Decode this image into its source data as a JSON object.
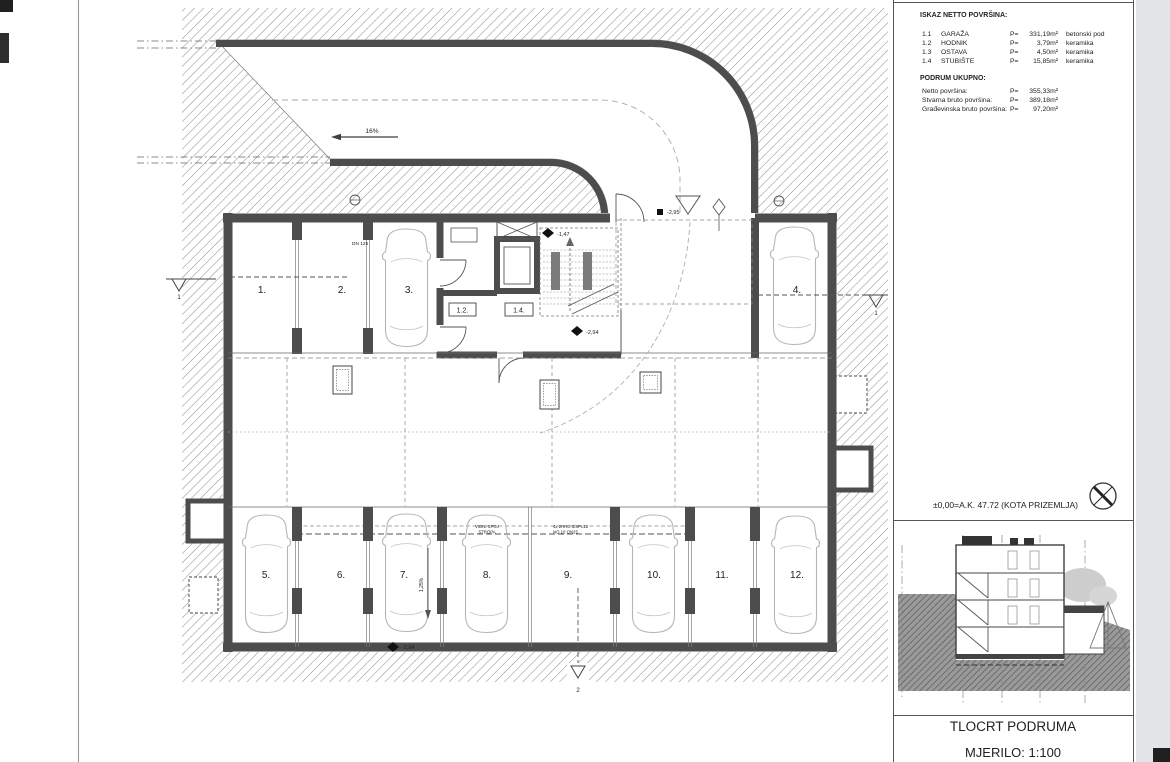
{
  "panel": {
    "header": "ISKAZ NETTO POVRŠINA:",
    "rows": [
      {
        "no": "1.1",
        "name": "GARAŽA",
        "p": "P=",
        "area": "331,19m²",
        "finish": "betonski pod"
      },
      {
        "no": "1.2",
        "name": "HODNIK",
        "p": "P=",
        "area": "3,79m²",
        "finish": "keramika"
      },
      {
        "no": "1.3",
        "name": "OSTAVA",
        "p": "P=",
        "area": "4,50m²",
        "finish": "keramika"
      },
      {
        "no": "1.4",
        "name": "STUBIŠTE",
        "p": "P=",
        "area": "15,85m²",
        "finish": "keramika"
      }
    ],
    "total_header": "PODRUM UKUPNO:",
    "totals": [
      {
        "label": "Netto površina:",
        "p": "P=",
        "value": "355,33m²"
      },
      {
        "label": "Stvarna bruto površina:",
        "p": "P=",
        "value": "389,18m²"
      },
      {
        "label": "Građevinska bruto površina:",
        "p": "P=",
        "value": "97,20m²"
      }
    ],
    "level_note": "±0,00=A.K. 47.72 (KOTA PRIZEMLJA)",
    "title": "TLOCRT PODRUMA",
    "scale": "MJERILO: 1:100"
  },
  "plan": {
    "spots": [
      "1.",
      "2.",
      "3.",
      "4.",
      "5.",
      "6.",
      "7.",
      "8.",
      "9.",
      "10.",
      "11.",
      "12."
    ],
    "room_labels": {
      "hodnik": "1.2.",
      "stubiste": "1.4."
    },
    "levels": {
      "stair_mid": "-1,47",
      "stair_low": "-2,94",
      "entry": "-2,95",
      "floor": "-2,94"
    },
    "ramp_slope": "16%",
    "floor_slope": "1,25%",
    "pipe": "DN 125",
    "ceiling_note_1": [
      "VIDNI SPOJ",
      "STROPA"
    ],
    "ceiling_note_2": [
      "4x 2RHD 3/SPL12",
      "NO 10 ON25"
    ],
    "section_marks": {
      "s1": "1",
      "s2": "2"
    }
  }
}
